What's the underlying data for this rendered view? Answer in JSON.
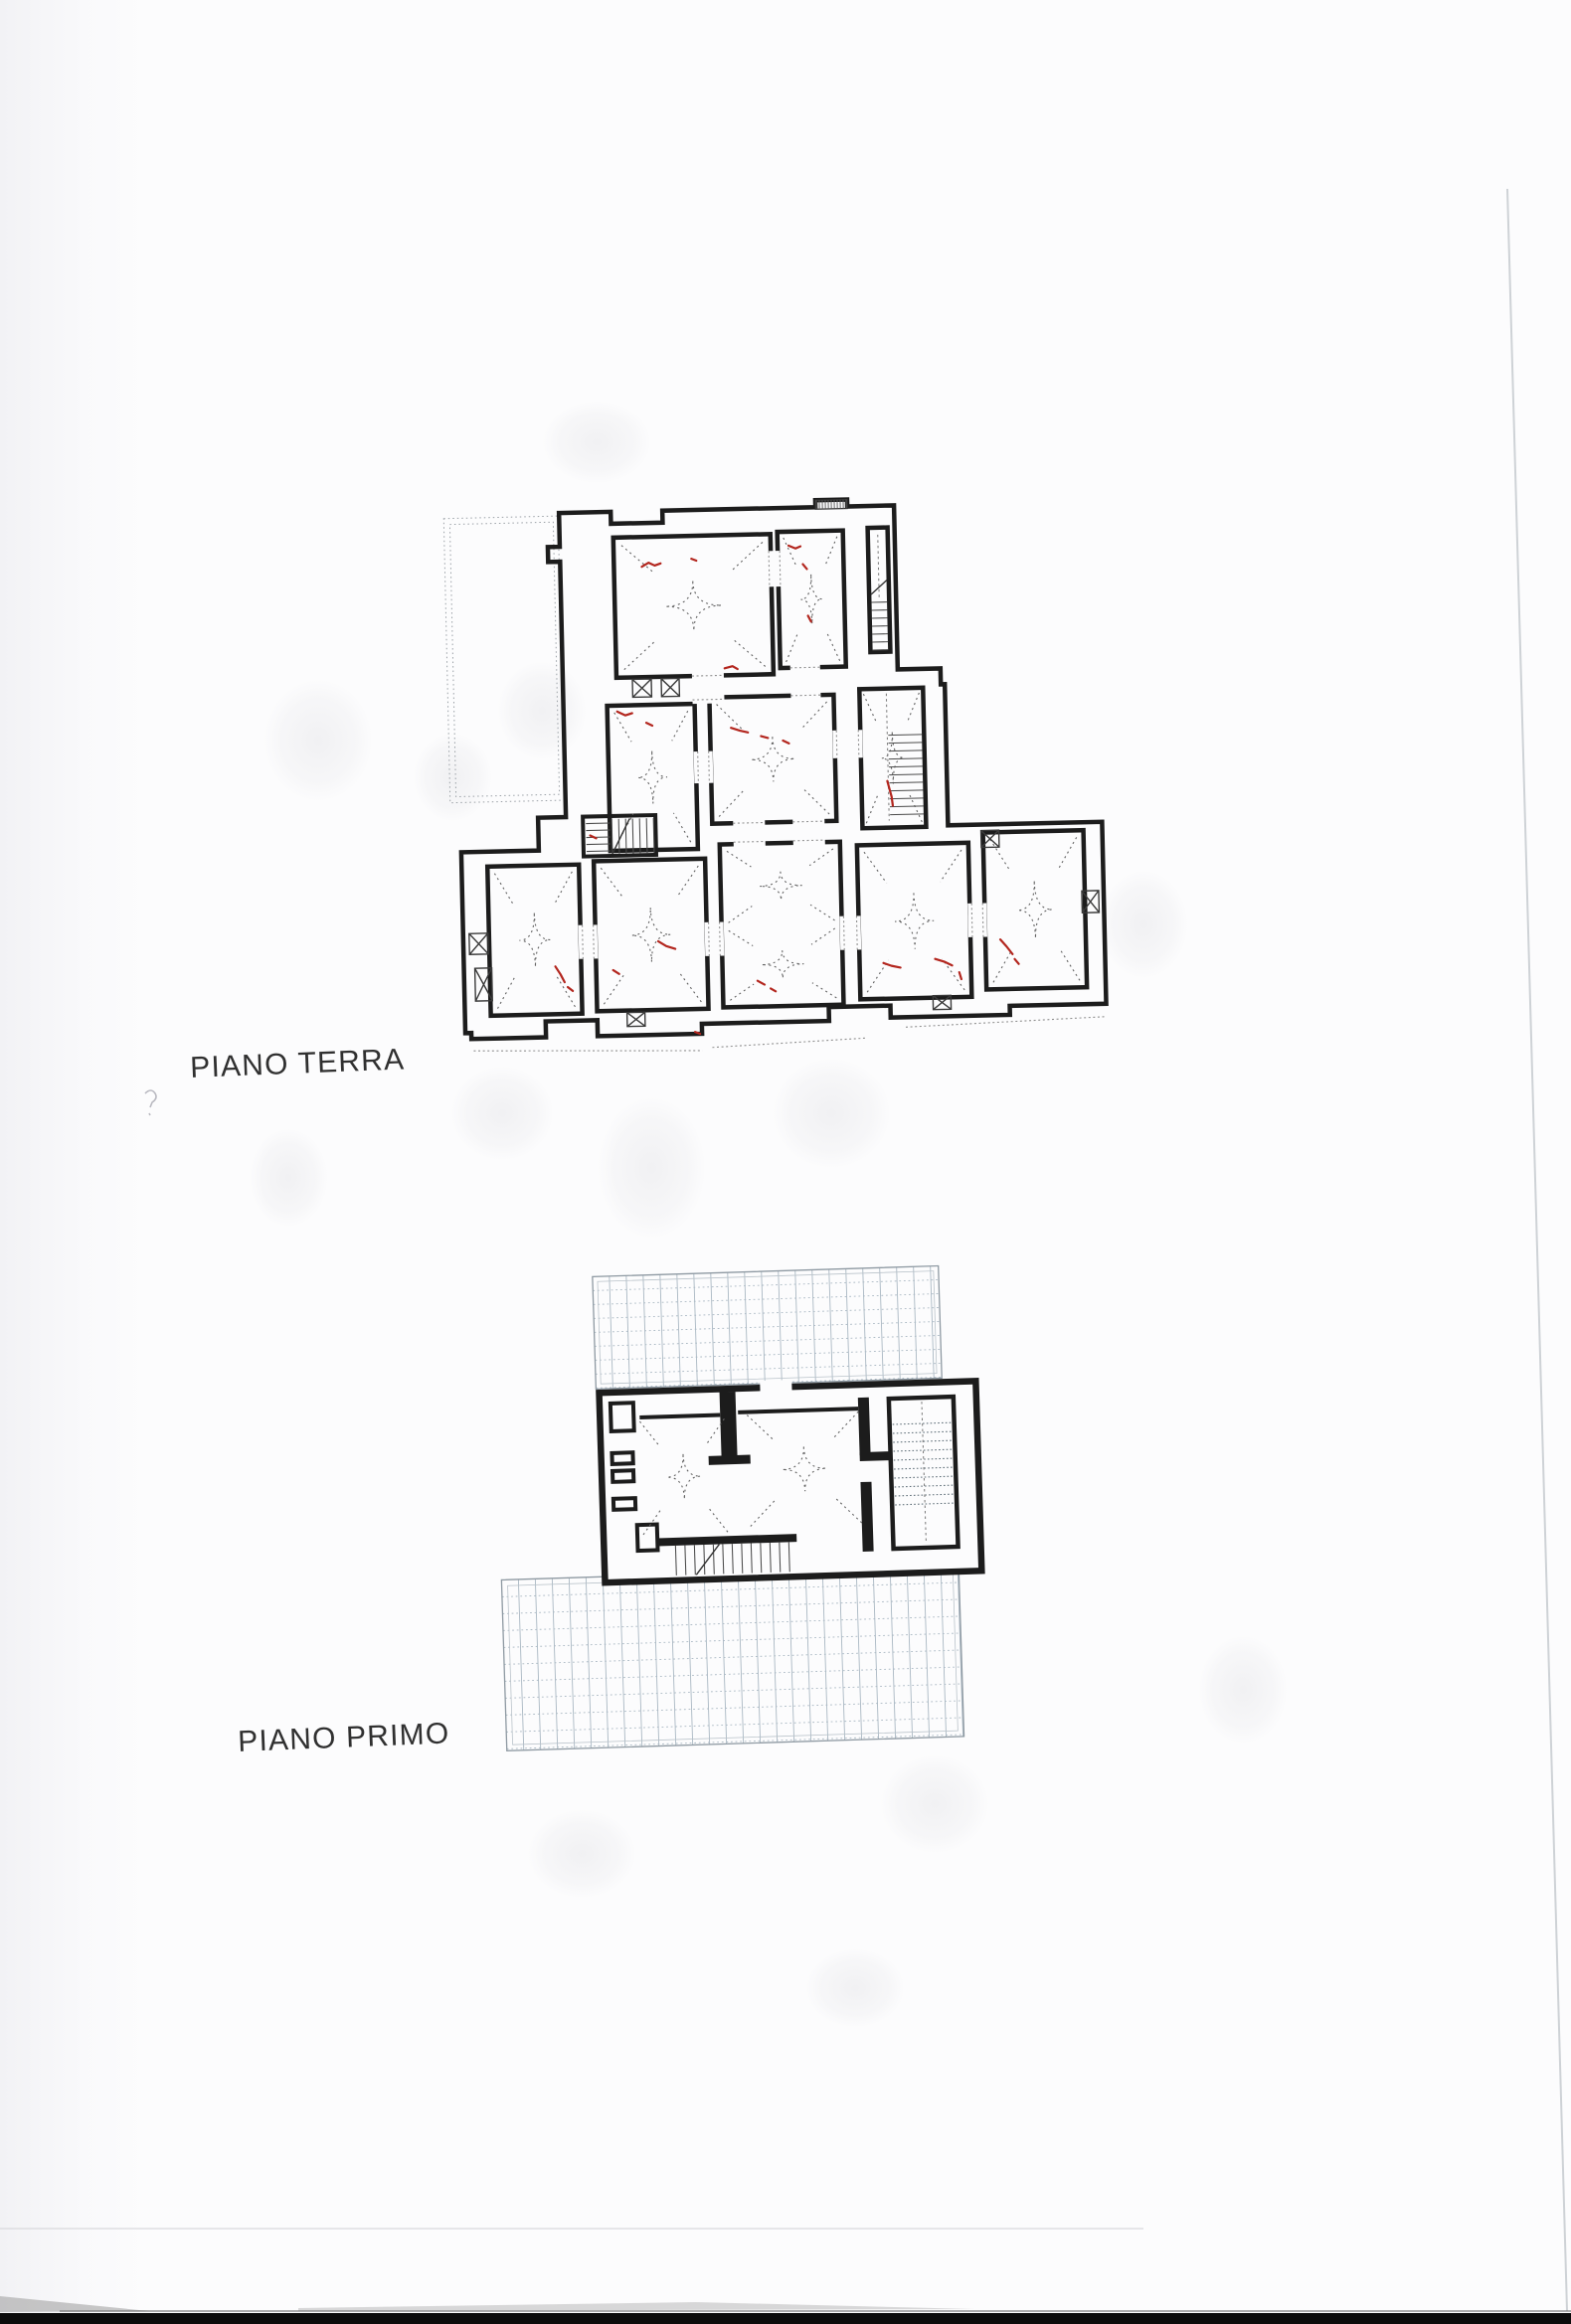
{
  "floors": [
    {
      "id": "piano-terra",
      "label": "PIANO TERRA"
    },
    {
      "id": "piano-primo",
      "label": "PIANO PRIMO"
    }
  ],
  "colors": {
    "paper": "#fcfcfd",
    "wall": "#1c1c1c",
    "vault_dash": "#626262",
    "crack_annotation_red": "#b3261e",
    "terrace_grid": "#aab8c3",
    "scan_bottom_bar": "#0b0b0b"
  }
}
